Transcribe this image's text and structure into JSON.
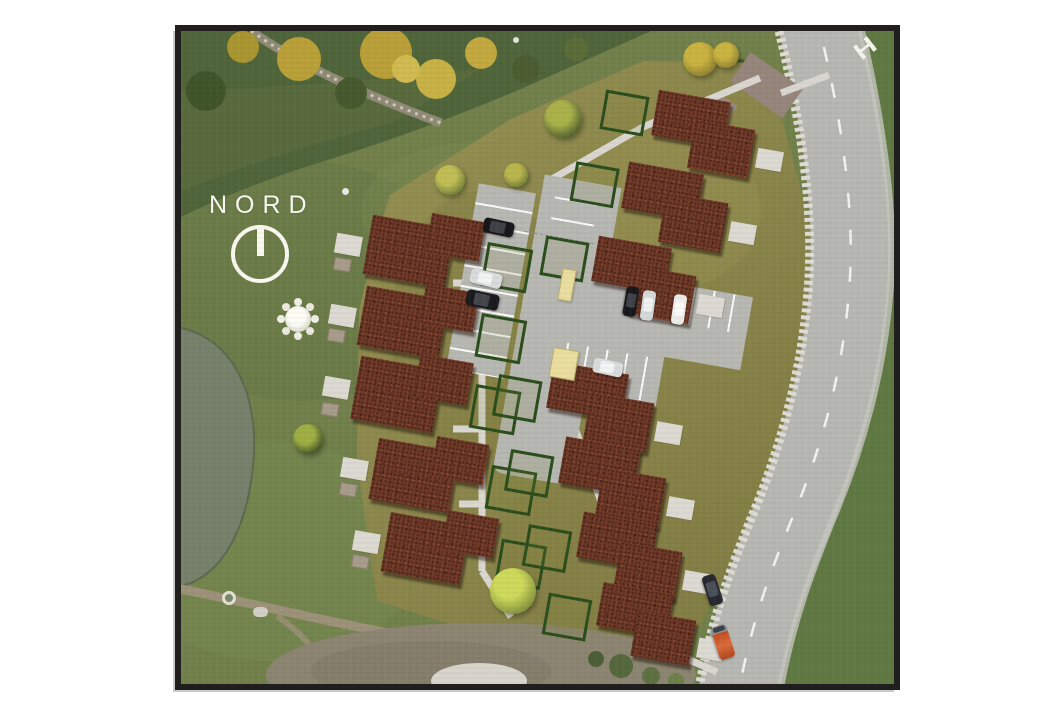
{
  "map": {
    "north_label": "NORD",
    "road_marking_label": "H"
  },
  "colors": {
    "frame": "#211f1d",
    "base_grass": "#71804a",
    "dark_vegetation": "#50643a",
    "site_grass": "#8d8a4c",
    "roof_brown": "#6d3726",
    "road_gray": "#b7b7b2",
    "roadside_grass": "#5f7842",
    "path_gray": "#d9d6cf",
    "hedge_green": "#2a4d1c",
    "pond_gray_green": "#76806b",
    "dirt_tan": "#9c9178",
    "sand_yellow": "#e9dd9e",
    "white": "#f8f8f0"
  }
}
